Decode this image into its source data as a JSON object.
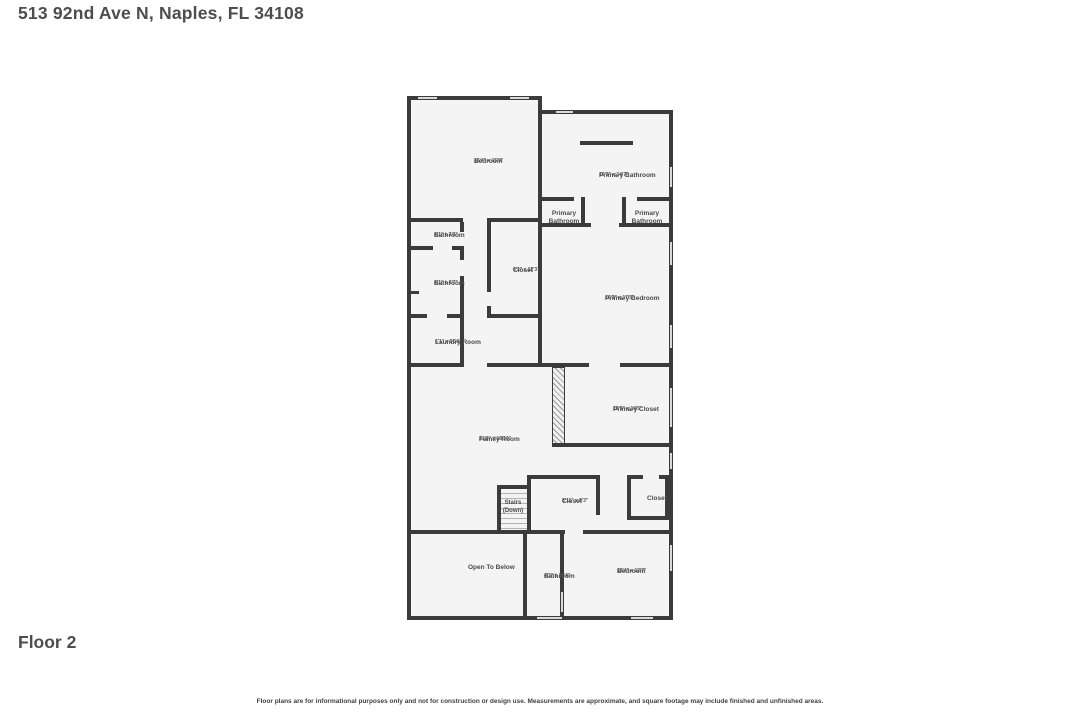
{
  "header": {
    "title": "513 92nd Ave N, Naples, FL 34108"
  },
  "floor": {
    "label": "Floor 2"
  },
  "footer": {
    "disclaimer": "Floor plans are for informational purposes only and not for construction or design use. Measurements are approximate, and square footage may include finished and unfinished areas."
  },
  "colors": {
    "wall": "#3b3b3b",
    "room_fill": "#f4f4f4",
    "window": "#d9d9d9",
    "label_text": "#4a4a4a"
  },
  "rooms": [
    {
      "name": "Bedroom",
      "dims": "16'4\" x 15'9\""
    },
    {
      "name": "Primary Bathroom",
      "dims": "16'3\" x 14'7\""
    },
    {
      "name": "Primary Bathroom",
      "dims": ""
    },
    {
      "name": "Primary Bathroom",
      "dims": ""
    },
    {
      "name": "Bathroom",
      "dims": "6'1\" x 3'3\""
    },
    {
      "name": "Closet",
      "dims": "6'2\" x 12'3\""
    },
    {
      "name": "Bathroom",
      "dims": "6'1\" x 8'7\""
    },
    {
      "name": "Primary Bedroom",
      "dims": "16'3\" x 17'5\""
    },
    {
      "name": "Laundry Room",
      "dims": "6'1\" x 5'10\""
    },
    {
      "name": "Primary Closet",
      "dims": "12'9\" x 10'5\""
    },
    {
      "name": "Family Room",
      "dims": "21'8\" x 18'10\""
    },
    {
      "name": "Stairs (Down)",
      "dims": ""
    },
    {
      "name": "Closet",
      "dims": "8'11\" x 8'3\""
    },
    {
      "name": "Closet",
      "dims": ""
    },
    {
      "name": "Open To Below",
      "dims": ""
    },
    {
      "name": "Bathroom",
      "dims": "4'3\" x 11'4\""
    },
    {
      "name": "Bedroom",
      "dims": "13'4\" x 12'7\""
    }
  ]
}
